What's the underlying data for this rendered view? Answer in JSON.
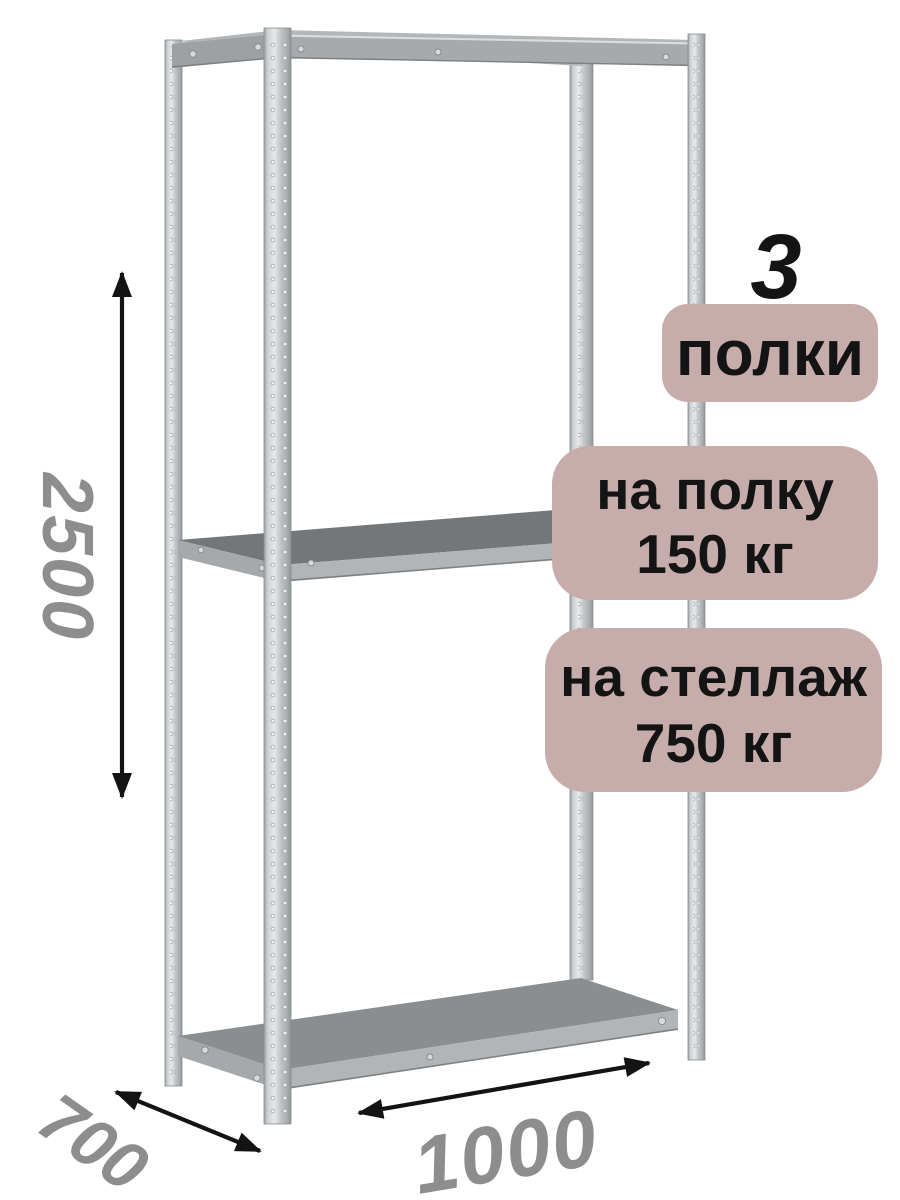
{
  "badges": {
    "shelf_count": "3",
    "shelf_count_label": "полки",
    "per_shelf": {
      "line1": "на полку",
      "line2": "150 кг"
    },
    "per_rack": {
      "line1": "на стеллаж",
      "line2": "750 кг"
    }
  },
  "dimensions": {
    "height_mm": "2500",
    "depth_mm": "700",
    "width_mm": "1000"
  },
  "colors": {
    "badge_bg": "#c7acac",
    "badge_text": "#141414",
    "dimension_text": "#8d8d8d",
    "arrow": "#131313",
    "background": "#ffffff"
  }
}
